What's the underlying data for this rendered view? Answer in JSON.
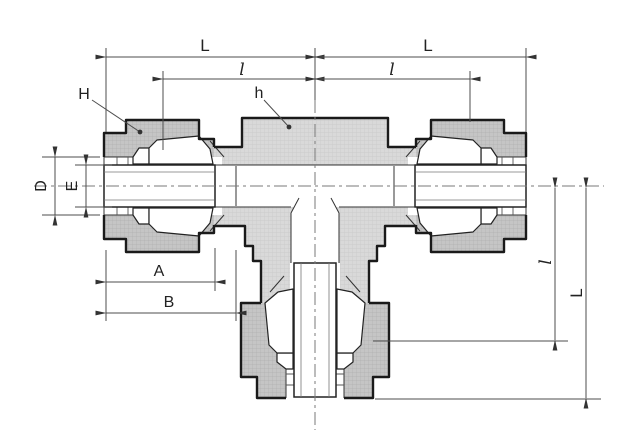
{
  "diagram": {
    "type": "engineering-cross-section",
    "subject": "union-tee-tube-fitting",
    "labels": {
      "L_top_left": "L",
      "l_top_left": "l",
      "L_top_right": "L",
      "l_top_right": "l",
      "H": "H",
      "h": "h",
      "D": "D",
      "E": "E",
      "A": "A",
      "B": "B",
      "l_right": "l",
      "L_right": "L"
    },
    "colors": {
      "outline": "#1a1a1a",
      "body_fill": "#d9d9d9",
      "nut_fill": "#c6c6c6",
      "dimension_lines": "#4d4d4d",
      "centerline": "#7a7a7a",
      "background": "#ffffff"
    }
  }
}
